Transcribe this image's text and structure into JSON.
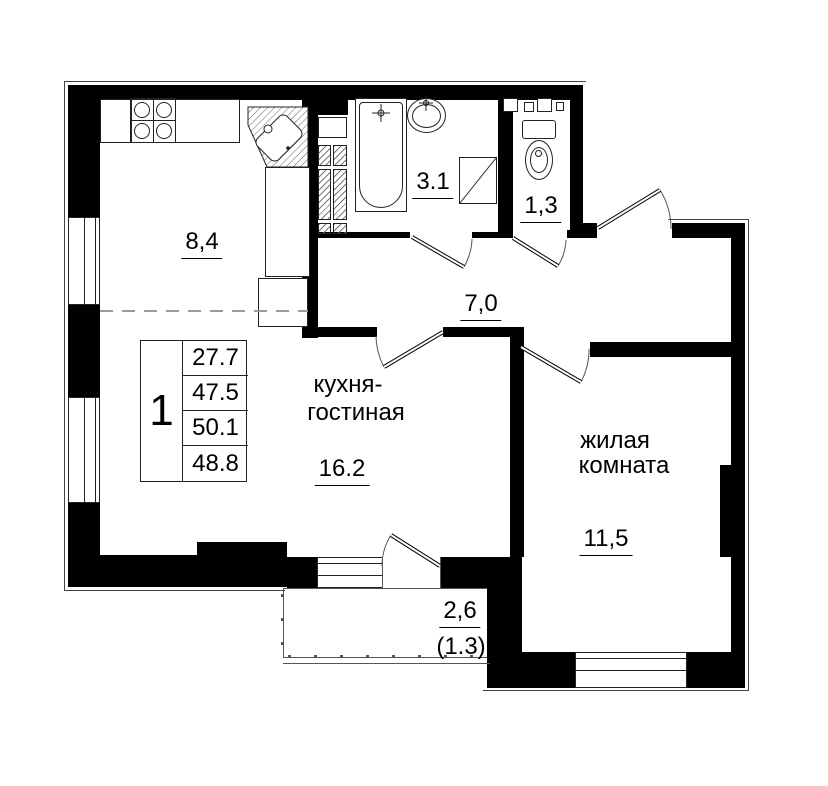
{
  "unit_table": {
    "unit_number": "1",
    "values": [
      "27.7",
      "47.5",
      "50.1",
      "48.8"
    ]
  },
  "rooms": {
    "kitchen_zone": {
      "area": "8,4"
    },
    "bathroom": {
      "area": "3.1"
    },
    "toilet": {
      "area": "1,3"
    },
    "hallway": {
      "area": "7,0"
    },
    "kitchen_living": {
      "name_line1": "кухня-",
      "name_line2": "гостиная",
      "area": "16.2"
    },
    "living_room": {
      "name_line1": "жилая",
      "name_line2": "комната",
      "area": "11,5"
    },
    "balcony": {
      "area": "2,6",
      "area_reduced": "(1.3)"
    }
  },
  "colors": {
    "wall": "#000000",
    "fixture_line": "#222222",
    "zone_dash": "#9b9b9b"
  }
}
